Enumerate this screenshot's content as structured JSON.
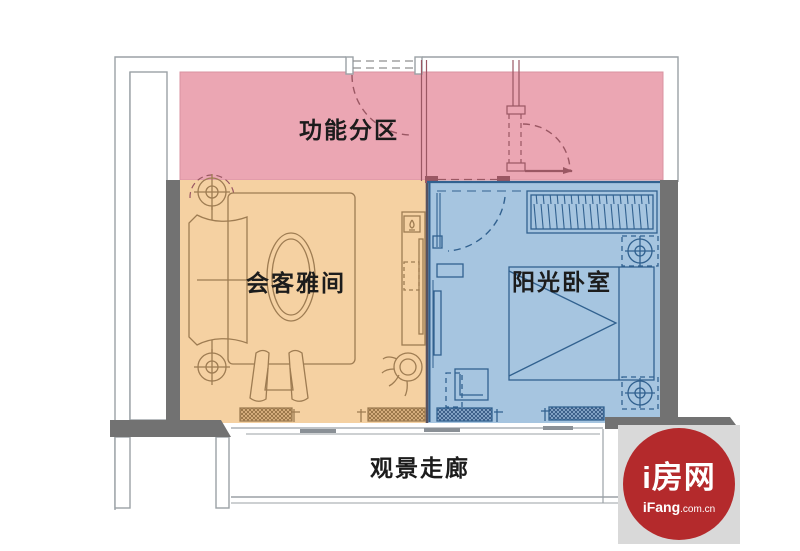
{
  "title": "apartment-floor-plan",
  "zones": {
    "functional": {
      "label": "功能分区",
      "fill": "#eba6b3",
      "line": "#9a5763"
    },
    "living": {
      "label": "会客雅间",
      "fill": "#f5d1a2",
      "line": "#9e7c52"
    },
    "bedroom": {
      "label": "阳光卧室",
      "fill": "#a6c5e0",
      "line": "#31618f"
    }
  },
  "corridor": {
    "label": "观景走廊"
  },
  "walls": {
    "thick_wall_color": "#727272",
    "outline_color": "#9ba1a6"
  },
  "label_text_color": "#1c1c1c",
  "watermark": {
    "brand": "i房网",
    "site_bold": "iFang",
    "site_suffix": ".com.cn",
    "circle_color": "#b42a2c",
    "panel_color": "#d9d9d9",
    "text_color": "#ffffff"
  }
}
